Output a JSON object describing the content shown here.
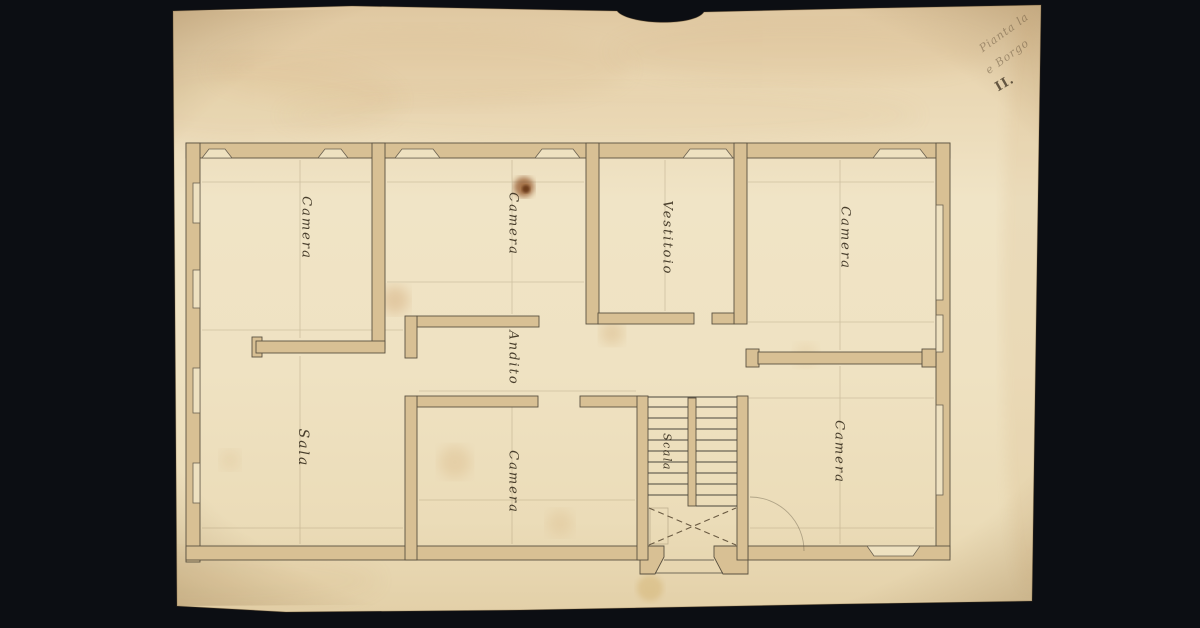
{
  "scene": {
    "background_color": "#0c0e13",
    "paper_color": "#efe2c2",
    "wall_fill_color": "#d8c094",
    "ink_color": "#5a5140",
    "label_ink_color": "#3b3120"
  },
  "rooms": [
    {
      "id": "camera-nw",
      "label": "Camera"
    },
    {
      "id": "camera-n",
      "label": "Camera"
    },
    {
      "id": "vestitoio",
      "label": "Vestitoio"
    },
    {
      "id": "camera-ne",
      "label": "Camera"
    },
    {
      "id": "andito",
      "label": "Andito"
    },
    {
      "id": "sala",
      "label": "Sala"
    },
    {
      "id": "camera-s",
      "label": "Camera"
    },
    {
      "id": "scala",
      "label": "Scala"
    },
    {
      "id": "camera-se",
      "label": "Camera"
    }
  ],
  "corner_annotation": {
    "line1": "Pianta la",
    "line2": "e Borgo",
    "numeral": "II."
  }
}
